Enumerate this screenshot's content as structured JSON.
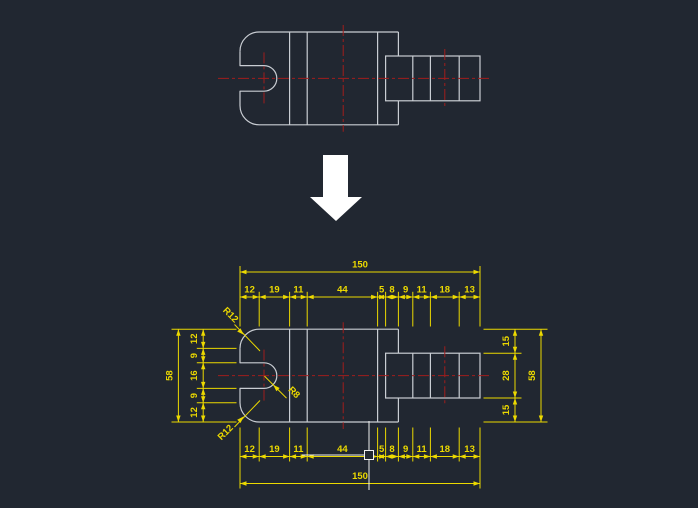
{
  "canvas": {
    "background_color": "#212731",
    "geometry_line_color": "#c9cdd3",
    "centerline_color": "#a01d1d",
    "dimension_color": "#ecd900",
    "cursor_color": "#f0f0f0",
    "transform_arrow_color": "#ffffff"
  },
  "dimensions": {
    "top_total": "150",
    "top_chain": [
      "12",
      "19",
      "11",
      "44",
      "5",
      "8",
      "9",
      "11",
      "18",
      "13"
    ],
    "bottom_chain": [
      "12",
      "19",
      "11",
      "44",
      "5",
      "8",
      "9",
      "11",
      "18",
      "13"
    ],
    "bottom_total": "150",
    "left_total": "58",
    "left_chain": [
      "12",
      "9",
      "16",
      "9",
      "12"
    ],
    "right_chain": [
      "15",
      "28",
      "15"
    ],
    "right_total": "58",
    "radius_top_left": "R12",
    "radius_bottom_left": "R12",
    "radius_slot": "R8"
  }
}
